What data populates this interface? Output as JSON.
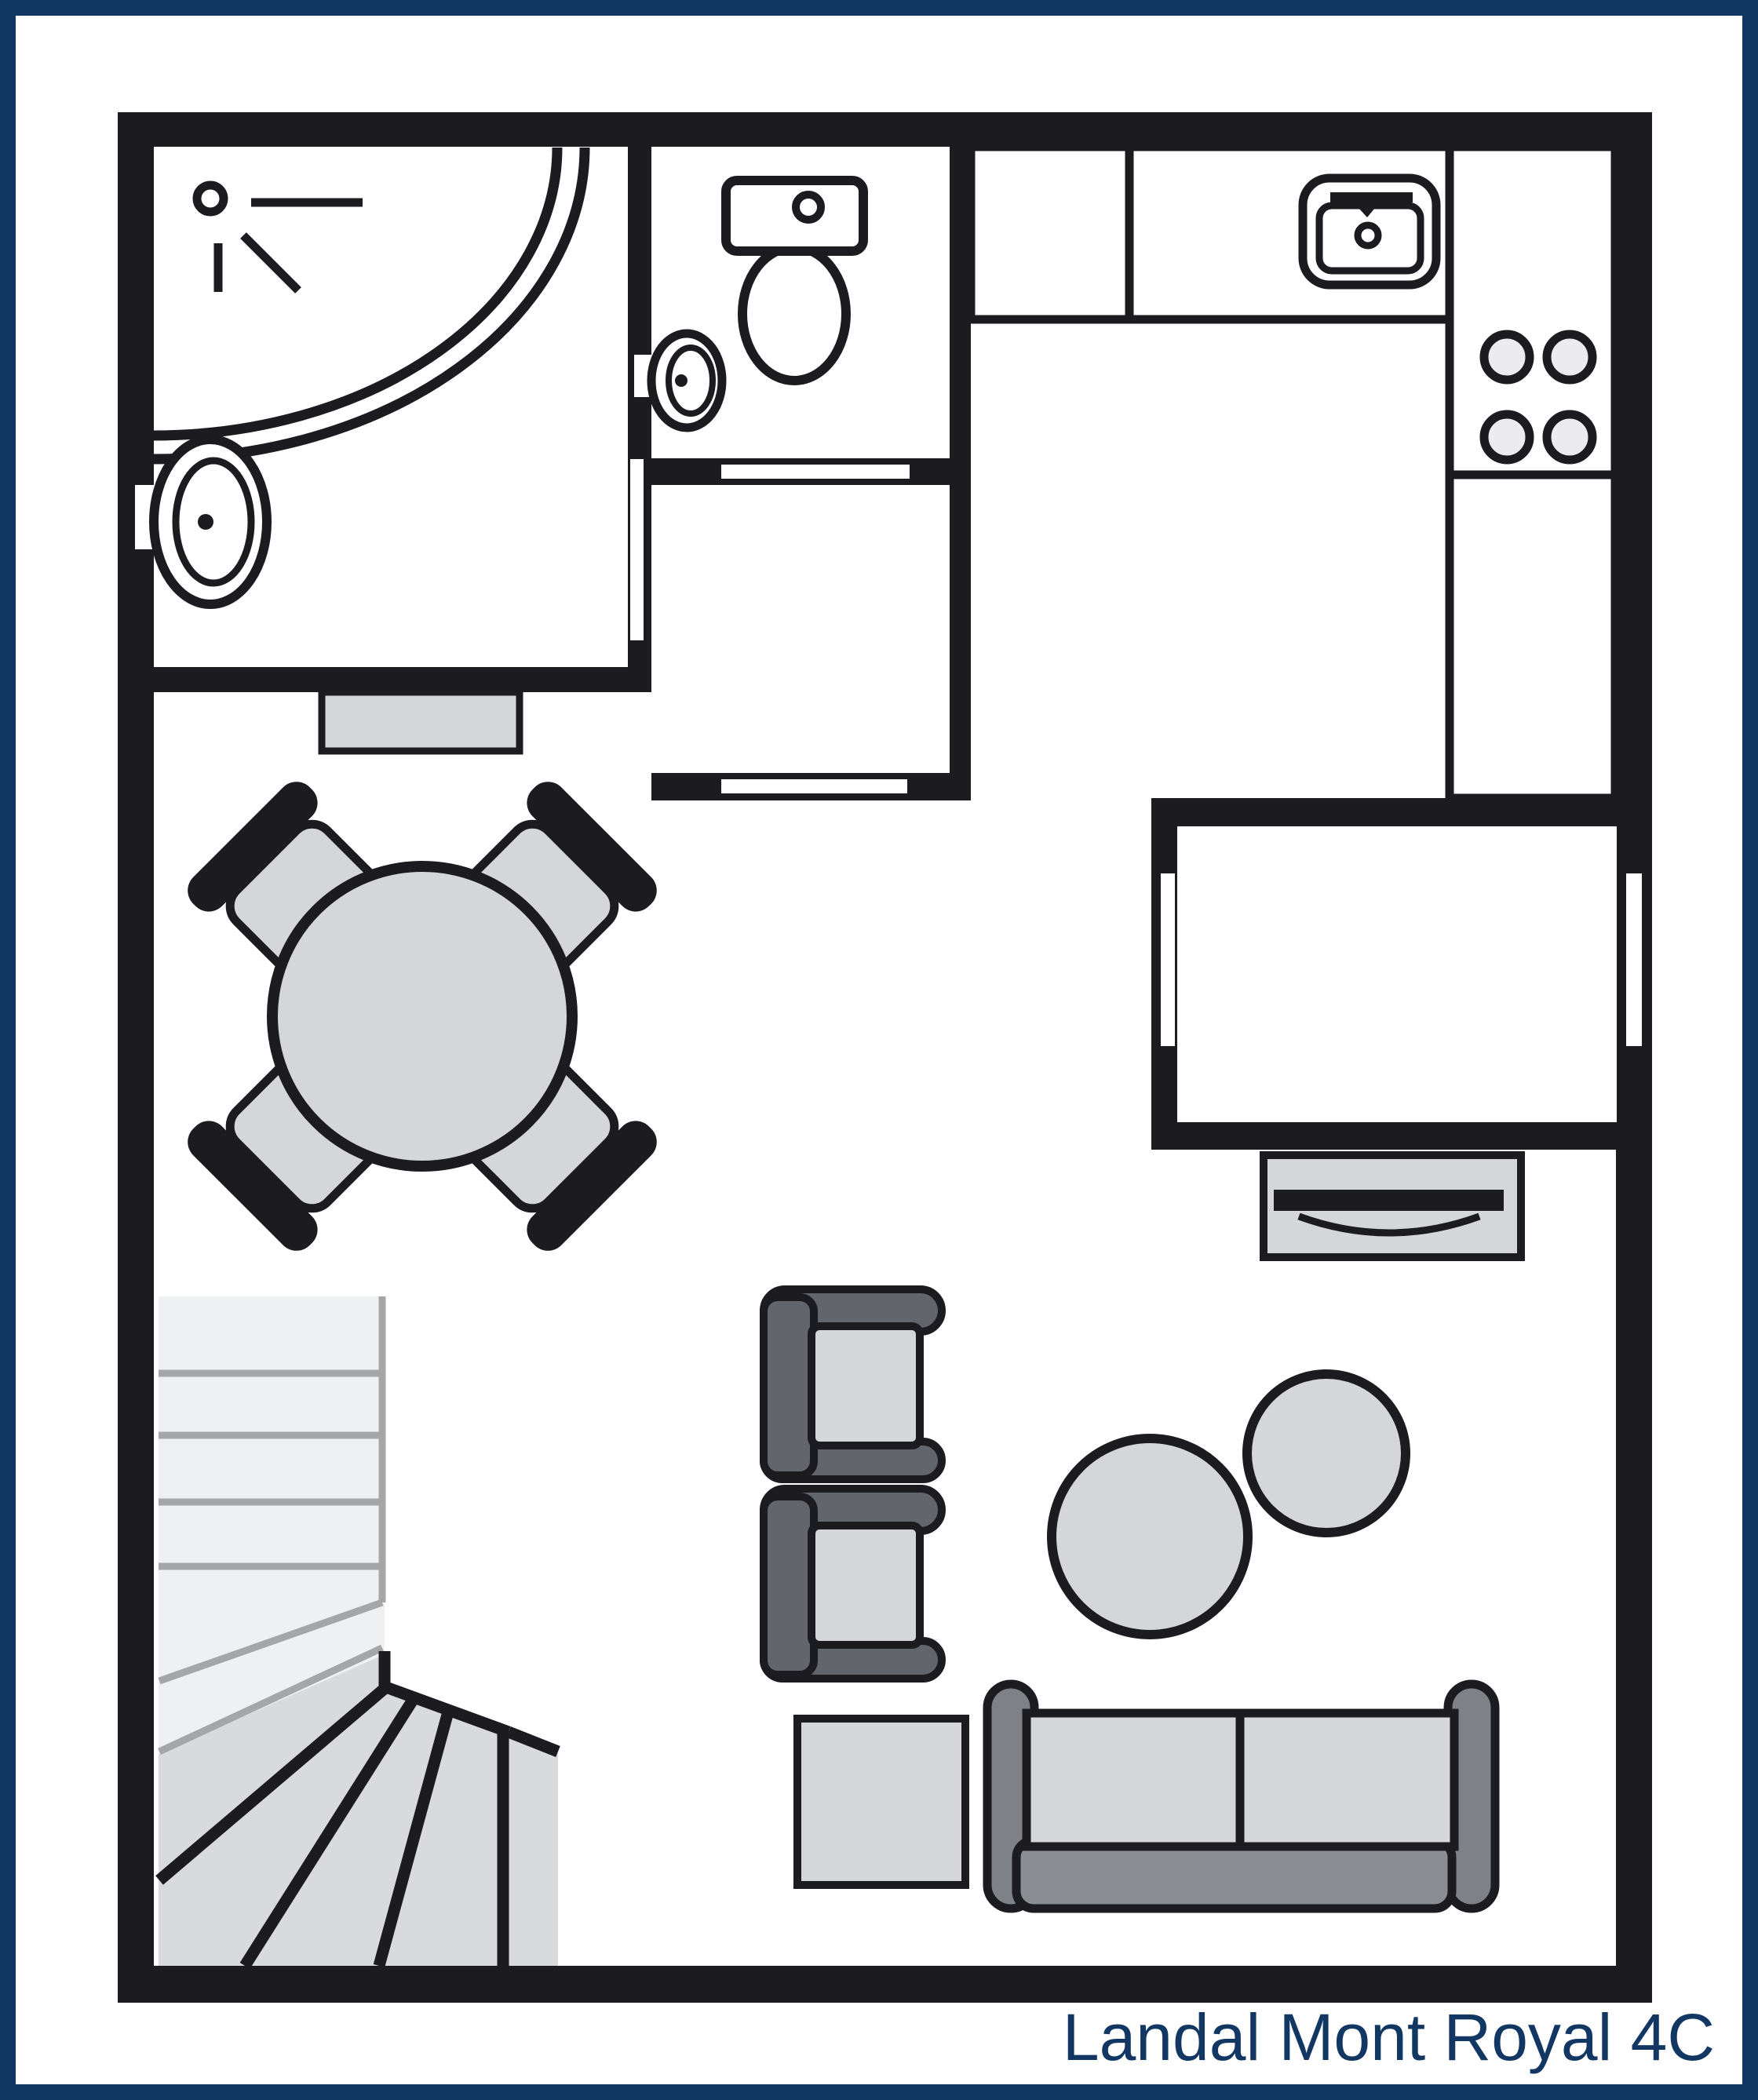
{
  "title": "Landal Mont Royal 4C",
  "colors": {
    "frame_navy": "#133763",
    "wall_black": "#1b1b20",
    "floor_white": "#ffffff",
    "page_bg": "#fbfbfc",
    "furn_gray": "#d4d6d8",
    "stair_light": "#eef0f1",
    "stair_mid": "#d9dadc",
    "sep_gray": "#a4a6a8",
    "arm_gray": "#62656c",
    "sofa_gray": "#7e8186",
    "band_gray": "#8a8d92",
    "hob_fill": "#ececee"
  },
  "fixtures": [
    "corner-shower",
    "shower-head",
    "bathroom-washbasin",
    "toilet",
    "wc-washbasin",
    "kitchen-counter",
    "kitchen-sink",
    "cooktop-4-burners",
    "window",
    "door-slot",
    "threshold-mat",
    "dining-table",
    "dining-chair",
    "stairs",
    "armchair",
    "side-table",
    "pouf",
    "sofa",
    "sideboard-tv"
  ]
}
